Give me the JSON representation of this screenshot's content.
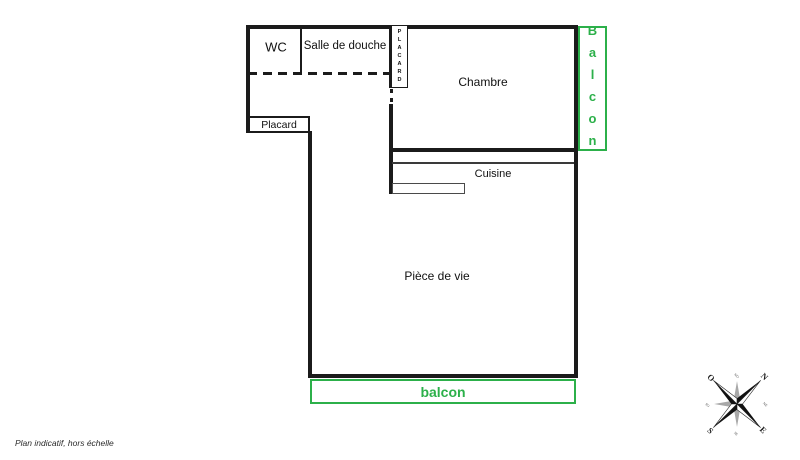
{
  "plan": {
    "footnote": "Plan indicatif, hors échelle",
    "rooms": {
      "wc": {
        "label": "WC"
      },
      "shower": {
        "label": "Salle de douche"
      },
      "bedroom": {
        "label": "Chambre"
      },
      "kitchen": {
        "label": "Cuisine"
      },
      "living": {
        "label": "Pièce de vie"
      },
      "closet_top": {
        "label": "PLACARD"
      },
      "closet_hall": {
        "label": "Placard"
      }
    },
    "balconies": {
      "right": {
        "label": "Balcon"
      },
      "bottom": {
        "label": "balcon"
      }
    },
    "colors": {
      "balcony_green": "#2cb04a",
      "wall_black": "#1b1b1b",
      "compass_gray": "#a8a8a8"
    },
    "compass": {
      "cardinals": {
        "n": "N",
        "e": "E",
        "s": "S",
        "o": "O"
      },
      "intercardinals": {
        "no": "NO",
        "ne": "NE",
        "se": "SE",
        "so": "SO"
      }
    }
  }
}
